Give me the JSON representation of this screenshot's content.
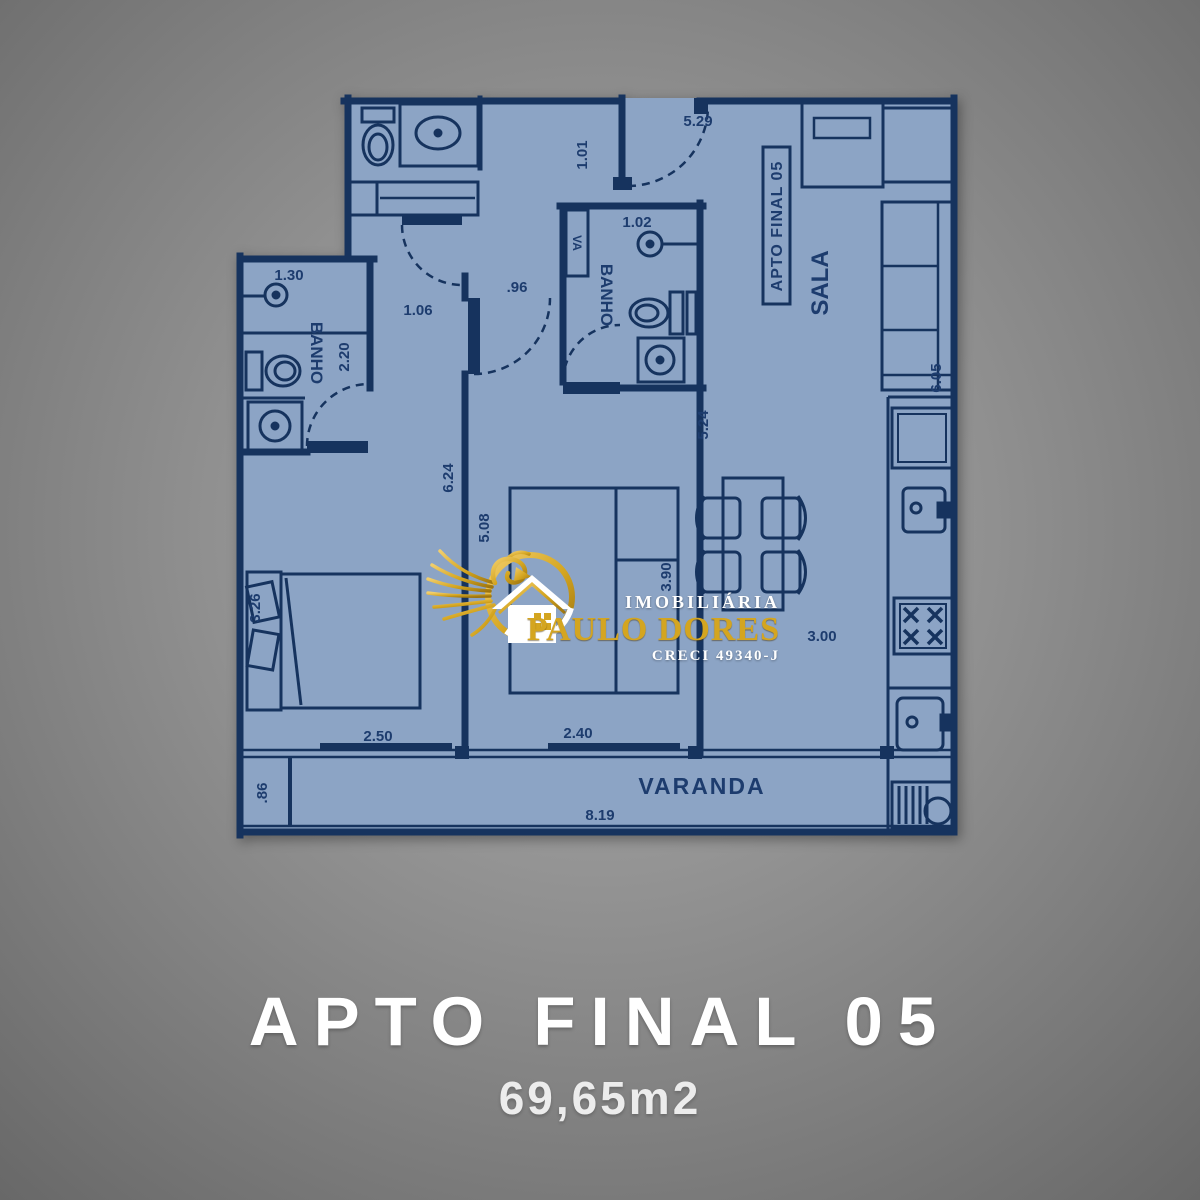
{
  "colors": {
    "background": "#8E8E8E",
    "floor": "#8CA4C5",
    "wall": "#16335E",
    "label": "#1D3C6E",
    "gold": "#D4A520",
    "white": "#FFFFFF"
  },
  "plan": {
    "unit_label": "APTO FINAL 05",
    "rooms": {
      "sala": "SALA",
      "banho_social": "BANHO",
      "banho_suite": "BANHO",
      "varanda": "VARANDA",
      "shaft": "VA"
    },
    "dims": {
      "entry_width": "5.29",
      "entry_side": "1.01",
      "shower_social": "1.02",
      "passage": ".96",
      "hall": "1.06",
      "shower_suite": "1.30",
      "banho_suite_depth": "2.20",
      "bedroom1_depth": "6.24",
      "bedroom2_depth": "5.08",
      "living_depth": "5.24",
      "living_width": "3.90",
      "bedroom1_side": "3.26",
      "bedroom1_width": "2.50",
      "bedroom2_width": "2.40",
      "kitchen_width": "3.00",
      "varanda_length": "8.19",
      "varanda_side": ".86",
      "sala_depth": "6.05"
    },
    "fixtures": [
      "toilet",
      "vanity-sink",
      "closet",
      "shower",
      "washbasin",
      "double-bed",
      "dining-table",
      "chairs",
      "sofa",
      "fridge",
      "kitchen-sink",
      "stove",
      "laundry-tank",
      "drying-rack"
    ]
  },
  "logo": {
    "brand_top": "IMOBILIÁRIA",
    "brand_main": "PAULO DORES",
    "brand_sub": "CRECI 49340-J"
  },
  "title": {
    "line1": "APTO FINAL 05",
    "line2": "69,65m2"
  }
}
